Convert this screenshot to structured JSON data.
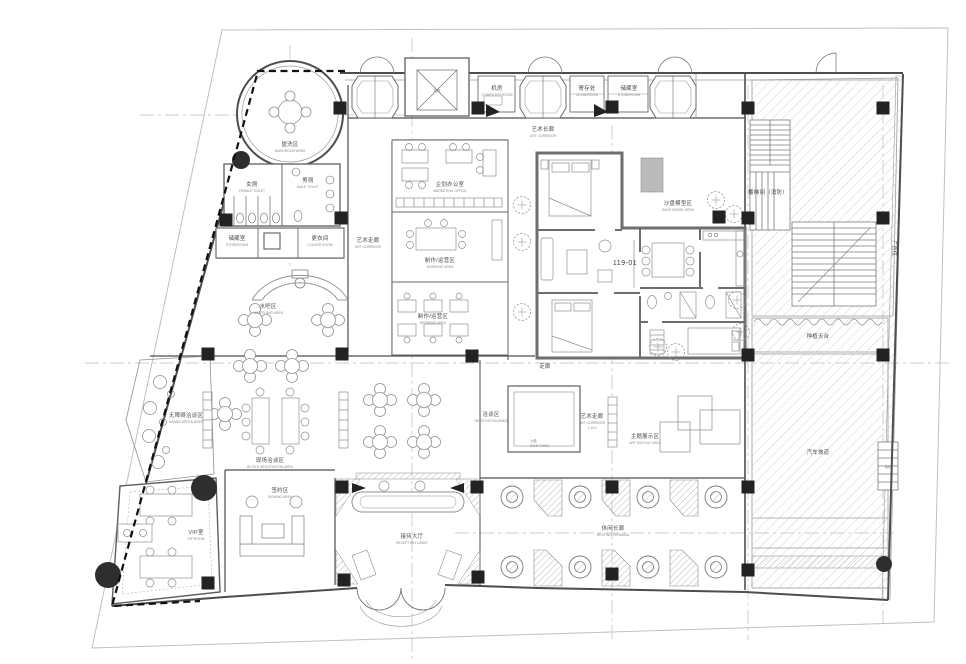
{
  "drawing": {
    "type": "architectural floor plan (sales center fit-out plan)",
    "unit_number": "119-01",
    "colors": {
      "wall": "#4d4d4d",
      "unit_wall": "#6e6e6e",
      "hatch": "#cfcfcf",
      "column": "#222222",
      "boundary_dashed": "#111111",
      "site_line": "#c0c0c0",
      "label": "#4a4a4a"
    },
    "labels": {
      "washroom": {
        "zh": "盥洗区",
        "en": "WASHROOM AREA"
      },
      "female_toilet": {
        "zh": "女厕",
        "en": "FEMALE TOILET"
      },
      "male_toilet": {
        "zh": "男厕",
        "en": "MALE TOILET"
      },
      "storeroom_left": {
        "zh": "储藏室",
        "en": "STOREROOM"
      },
      "locker_room": {
        "zh": "更衣间",
        "en": "LOCKER ROOM"
      },
      "water_bar": {
        "zh": "水吧区",
        "en": "WATER BAR AREA"
      },
      "art_corridor_left": {
        "zh": "艺术走廊",
        "en": "ART CORRIDOR"
      },
      "art_corridor_top": {
        "zh": "艺术长廊",
        "en": "ART CORRIDOR"
      },
      "art_corridor_mid": {
        "zh": "艺术走廊",
        "en": "ART CORRIDOR",
        "code": "1.10.4"
      },
      "corridor_b": {
        "zh": "走廊",
        "en": "CORRIDOR"
      },
      "computer_room": {
        "zh": "机房",
        "en": "COMPUTER ROOM"
      },
      "cloakroom": {
        "zh": "寄存处",
        "en": "CLOAKROOM"
      },
      "storeroom_top": {
        "zh": "储藏室",
        "en": "STOREROOM"
      },
      "elevator": {
        "zh": "电梯"
      },
      "marketing_office": {
        "zh": "企划办公室",
        "en": "MARKETING OFFICE"
      },
      "work_area_1": {
        "zh": "制作/运营区",
        "en": "WORKING AREA"
      },
      "work_area_2": {
        "zh": "制作/运营区",
        "en": "WORKING AREA"
      },
      "model_area": {
        "zh": "沙盘模型区",
        "en": "SAND MODEL AREA"
      },
      "unit_number": {
        "text": "119-01"
      },
      "stair_fire": {
        "zh": "楼梯间（消防）"
      },
      "ad_space": {
        "zh": "广告位"
      },
      "terrace": {
        "zh": "种植天台"
      },
      "car_ramp": {
        "zh": "汽车坡道"
      },
      "stair_small": {
        "zh": "楼梯"
      },
      "negotiation_main": {
        "zh": "现场洽谈区",
        "en": "IN-SITE NEGOTIATION AREA"
      },
      "handicapped": {
        "zh": "无障碍洽谈区",
        "en": "HANDICAPPED AREA"
      },
      "negotiation_b": {
        "zh": "洽谈区",
        "en": "NEGOTIATION AREA"
      },
      "sand_table": {
        "zh": "沙盘",
        "en": "SAND TABLE"
      },
      "theme_display": {
        "zh": "主题展示区",
        "en": "ART DISPLAY AREA"
      },
      "reception": {
        "zh": "接待大厅",
        "en": "RECEPTION LOBBY"
      },
      "signing_room": {
        "zh": "签约区",
        "en": "SIGNING AREA"
      },
      "vip_room": {
        "zh": "VIP室",
        "en": "VIP ROOM"
      },
      "veranda": {
        "zh": "休闲长廊",
        "en": "RESTING VERANDA"
      }
    }
  }
}
